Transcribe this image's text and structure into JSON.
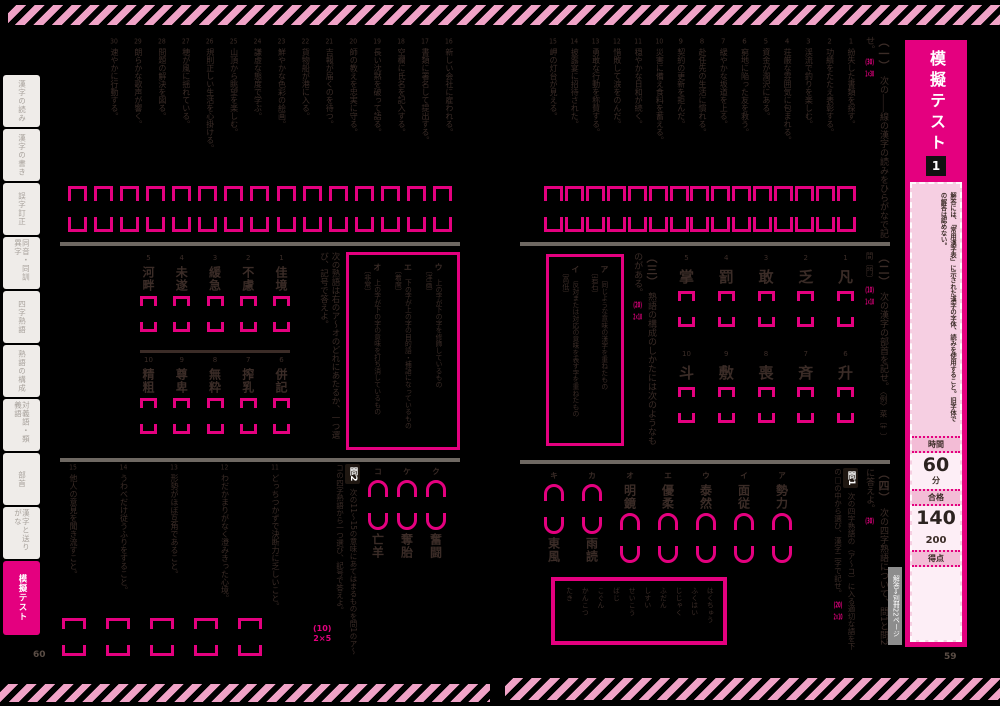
{
  "colors": {
    "accent": "#e4007f",
    "stripe": "#f0a3c7",
    "ink": "#3b2c27"
  },
  "page_numbers": {
    "left": "60",
    "right": "59"
  },
  "sidebar": {
    "tabs": [
      "漢字の読み",
      "漢字の書き",
      "誤字訂正",
      "同音・同訓異字",
      "四字熟語",
      "熟語の構成",
      "対義語・類義語",
      "部首",
      "漢字と送りがな"
    ],
    "active_tab": "模擬テスト"
  },
  "banner": {
    "title": "模擬テスト",
    "number": "1",
    "note": "解答には、「常用漢字表」に示された漢字の字体、読みを使用すること。旧字体での解答は認めない。",
    "time_label": "時間",
    "time_value": "60",
    "time_unit": "分",
    "pass_label": "合格",
    "pass_value": "140",
    "pass_total": "200",
    "score_label": "得点",
    "answer_ref": "解答⇒別冊22ページ"
  },
  "right_page": {
    "sec1": {
      "num": "（一）",
      "instruction": "次の――線の漢字の読みをひらがなで記せ。",
      "score": "(30)",
      "per": "1×30",
      "questions": [
        {
          "no": "1",
          "text": "紛失した書類を探す。"
        },
        {
          "no": "2",
          "text": "功績をたたえ表彰する。"
        },
        {
          "no": "3",
          "text": "渓流で釣りを楽しむ。"
        },
        {
          "no": "4",
          "text": "荘厳な雰囲気に包まれる。"
        },
        {
          "no": "5",
          "text": "資金が潤沢にある。"
        },
        {
          "no": "6",
          "text": "窮地に陥った友を救う。"
        },
        {
          "no": "7",
          "text": "緩やかな坂道を上る。"
        },
        {
          "no": "8",
          "text": "赴任先の生活に慣れる。"
        },
        {
          "no": "9",
          "text": "契約の更新を拒んだ。"
        },
        {
          "no": "10",
          "text": "災害に備え食料を蓄える。"
        },
        {
          "no": "11",
          "text": "穏やかな日和が続く。"
        },
        {
          "no": "12",
          "text": "惜敗して涙をのんだ。"
        },
        {
          "no": "13",
          "text": "勇敢な行動を称賛する。"
        },
        {
          "no": "14",
          "text": "披露宴に招待された。"
        },
        {
          "no": "15",
          "text": "岬の灯台が見える。"
        }
      ]
    },
    "sec2": {
      "num": "（二）",
      "instruction": "次の漢字の部首を記せ。",
      "example": "〈例〉菜〔艹〕間〔門〕",
      "score": "(10)",
      "per": "1×10",
      "row1": [
        {
          "no": "1",
          "kanji": "凡"
        },
        {
          "no": "2",
          "kanji": "乏"
        },
        {
          "no": "3",
          "kanji": "敢"
        },
        {
          "no": "4",
          "kanji": "罰"
        },
        {
          "no": "5",
          "kanji": "掌"
        }
      ],
      "row2": [
        {
          "no": "6",
          "kanji": "升"
        },
        {
          "no": "7",
          "kanji": "斉"
        },
        {
          "no": "8",
          "kanji": "喪"
        },
        {
          "no": "9",
          "kanji": "敷"
        },
        {
          "no": "10",
          "kanji": "斗"
        }
      ]
    },
    "sec3": {
      "num": "（三）",
      "instruction": "熟語の構成のしかたには次のようなものがある。",
      "score": "(20)",
      "per": "2×10",
      "options": [
        {
          "key": "ア",
          "text": "同じような意味の漢字を重ねたもの",
          "example": "〔岩石〕"
        },
        {
          "key": "イ",
          "text": "反対または対応の意味を表す字を重ねたもの",
          "example": "〔高低〕"
        }
      ]
    },
    "sec4": {
      "num": "（四）",
      "instruction": "次の四字熟語について、問1と問2に答えよ。",
      "score": "(30)",
      "q1_label": "問1",
      "q1_instruction": "次の四字熟語の（ア〜コ）に入る適切な語を下の□の中から選び、漢字二字で記せ。",
      "q1_score": "(20)",
      "q1_per": "2×10",
      "q1_items": [
        {
          "key": "ア",
          "given": "勢力",
          "box_pos": "bottom"
        },
        {
          "key": "イ",
          "given": "面従",
          "box_pos": "bottom"
        },
        {
          "key": "ウ",
          "given": "泰然",
          "box_pos": "bottom"
        },
        {
          "key": "エ",
          "given": "優柔",
          "box_pos": "bottom"
        },
        {
          "key": "オ",
          "given": "明鏡",
          "box_pos": "bottom"
        },
        {
          "key": "カ",
          "given": "雨読",
          "box_pos": "top"
        },
        {
          "key": "キ",
          "given": "東風",
          "box_pos": "top"
        }
      ],
      "hints": [
        "はくちゅう",
        "ふくはい",
        "じじゃく",
        "ふだん",
        "しすい",
        "せいこう",
        "ばじ",
        "こぐん",
        "かんこつ",
        "たき"
      ]
    }
  },
  "left_page": {
    "sec1_questions": [
      {
        "no": "16",
        "text": "新しい会社に雇われる。"
      },
      {
        "no": "17",
        "text": "書類に署名して提出する。"
      },
      {
        "no": "18",
        "text": "空欄に氏名を記入する。"
      },
      {
        "no": "19",
        "text": "長い沈黙を破って語る。"
      },
      {
        "no": "20",
        "text": "師の教えを忠実に守る。"
      },
      {
        "no": "21",
        "text": "吉報が届くのを待つ。"
      },
      {
        "no": "22",
        "text": "貨物船が港に入る。"
      },
      {
        "no": "23",
        "text": "鮮やかな色彩の絵画。"
      },
      {
        "no": "24",
        "text": "謙虚な態度で学ぶ。"
      },
      {
        "no": "25",
        "text": "山頂から眺望を楽しむ。"
      },
      {
        "no": "26",
        "text": "規則正しい生活を心掛ける。"
      },
      {
        "no": "27",
        "text": "穂が風に揺れている。"
      },
      {
        "no": "28",
        "text": "問題の解決を図る。"
      },
      {
        "no": "29",
        "text": "朗らかな歌声が響く。"
      },
      {
        "no": "30",
        "text": "速やかに行動する。"
      }
    ],
    "sec3": {
      "instruction": "次の熟語は右のア〜オのどれにあたるか、一つ選び、記号で答えよ。",
      "options": [
        {
          "key": "ウ",
          "text": "上の字が下の字を修飾しているもの",
          "example": "〔洋画〕"
        },
        {
          "key": "エ",
          "text": "下の字が上の字の目的語・補語になっているもの",
          "example": "〔着席〕"
        },
        {
          "key": "オ",
          "text": "上の字が下の字の意味を打ち消しているもの",
          "example": "〔非常〕"
        }
      ],
      "row1": [
        {
          "no": "1",
          "word": "佳境"
        },
        {
          "no": "2",
          "word": "不慮"
        },
        {
          "no": "3",
          "word": "緩急"
        },
        {
          "no": "4",
          "word": "未遂"
        },
        {
          "no": "5",
          "word": "河畔"
        }
      ],
      "row2": [
        {
          "no": "6",
          "word": "併記"
        },
        {
          "no": "7",
          "word": "搾乳"
        },
        {
          "no": "8",
          "word": "無粋"
        },
        {
          "no": "9",
          "word": "尊卑"
        },
        {
          "no": "10",
          "word": "精粗"
        }
      ]
    },
    "sec4": {
      "q1_items": [
        {
          "key": "ク",
          "given": "奮闘",
          "box_pos": "top"
        },
        {
          "key": "ケ",
          "given": "奪胎",
          "box_pos": "top"
        },
        {
          "key": "コ",
          "given": "亡羊",
          "box_pos": "top"
        }
      ],
      "q2_label": "問2",
      "q2_instruction": "次の11〜15の意味にあてはまるものを問1のア〜コの四字熟語から一つ選び、記号で答えよ。",
      "q2_score": "(10)",
      "q2_per": "2×5",
      "q2_questions": [
        {
          "no": "11",
          "text": "どっちつかずで決断力に乏しいこと。"
        },
        {
          "no": "12",
          "text": "わだかまりがなく澄みきった心境。"
        },
        {
          "no": "13",
          "text": "形勢がほぼ互角であること。"
        },
        {
          "no": "14",
          "text": "うわべだけ従うふりをすること。"
        },
        {
          "no": "15",
          "text": "他人の意見を聞き流すこと。"
        }
      ]
    }
  }
}
